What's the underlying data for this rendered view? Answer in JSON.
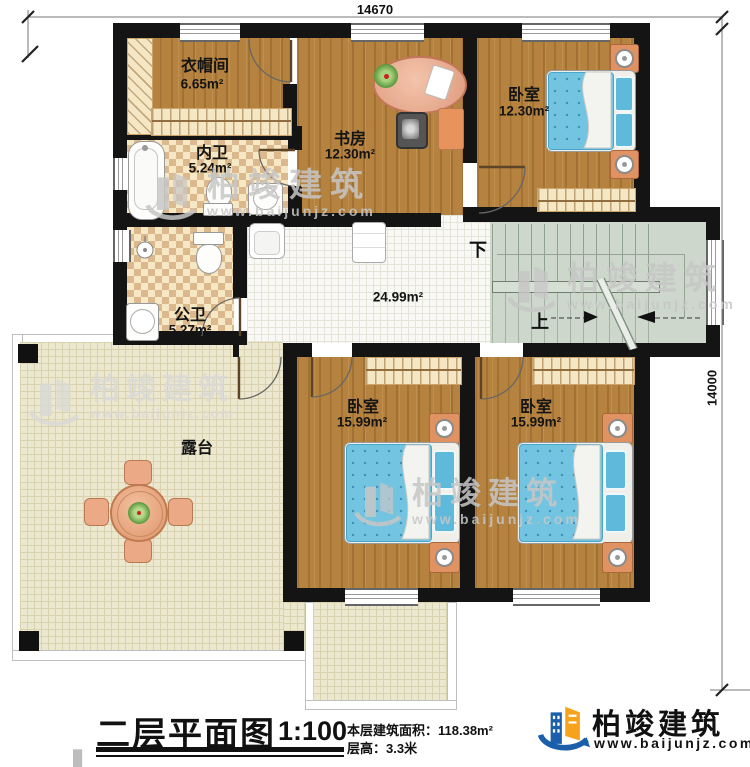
{
  "dimensions": {
    "width": "14670",
    "height": "14000"
  },
  "rooms": [
    {
      "id": "cloakroom",
      "name": "衣帽间",
      "area": "6.65m²"
    },
    {
      "id": "inner-bath",
      "name": "内卫",
      "area": "5.24m²"
    },
    {
      "id": "public-bath",
      "name": "公卫",
      "area": "5.27m²"
    },
    {
      "id": "study",
      "name": "书房",
      "area": "12.30m²"
    },
    {
      "id": "bedroom-top",
      "name": "卧室",
      "area": "12.30m²"
    },
    {
      "id": "hall",
      "name": "",
      "area": "24.99m²"
    },
    {
      "id": "bedroom-left",
      "name": "卧室",
      "area": "15.99m²"
    },
    {
      "id": "bedroom-right",
      "name": "卧室",
      "area": "15.99m²"
    },
    {
      "id": "terrace",
      "name": "露台",
      "area": ""
    }
  ],
  "stairs": {
    "down_label": "下",
    "up_label": "上"
  },
  "title_block": {
    "title": "二层平面图",
    "scale": "1:100",
    "area_label": "本层建筑面积：",
    "area_value": "118.38m²",
    "floor_height_label": "层高：",
    "floor_height_value": "3.3米"
  },
  "brand": {
    "name": "柏竣建筑",
    "website": "www.baijunjz.com"
  },
  "watermark": {
    "name": "柏竣建筑",
    "website": "www.baijunjz.com"
  },
  "colors": {
    "wall": "#141414",
    "brand_blue": "#1b5ea9",
    "brand_orange": "#f6a21c",
    "bed_blue": "#72c4e1"
  }
}
